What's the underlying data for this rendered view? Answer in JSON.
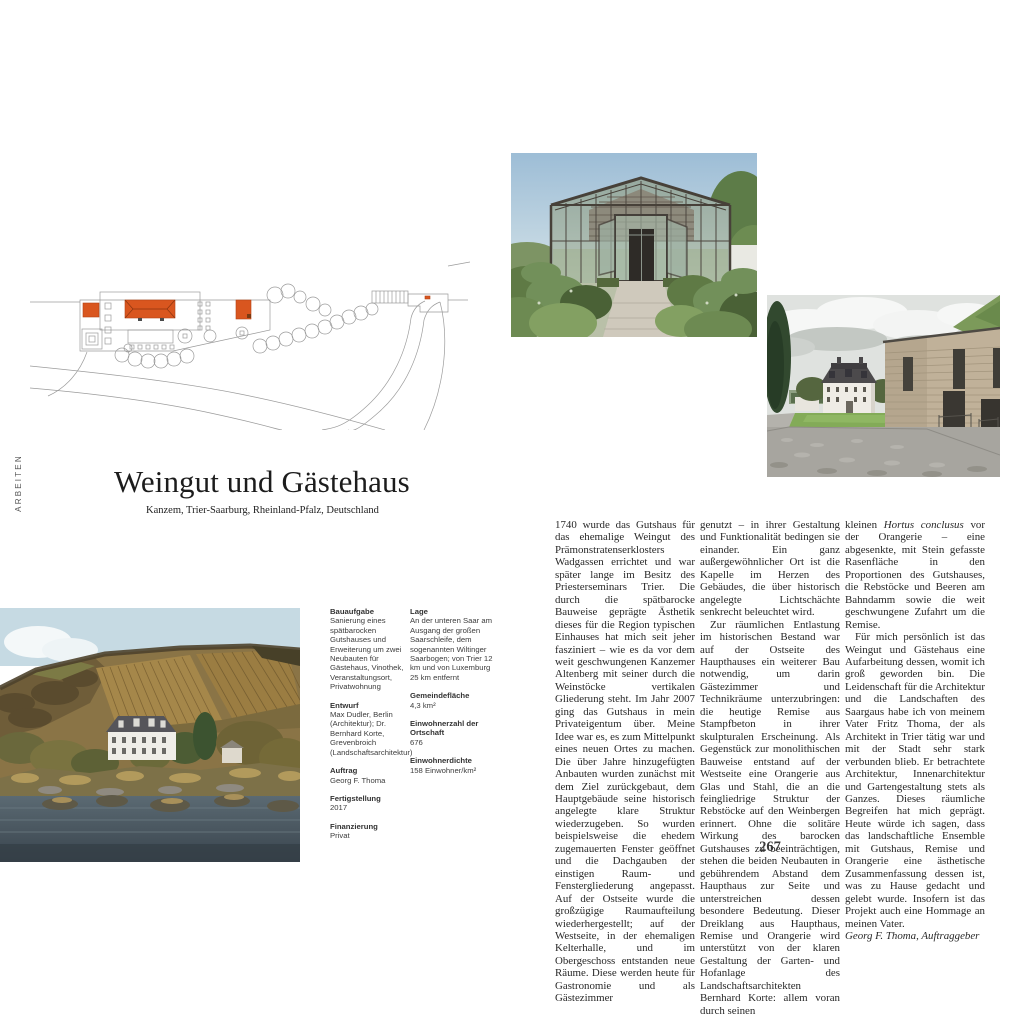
{
  "accent_color": "#d9561f",
  "page": {
    "spine_label": "ARBEITEN",
    "number": "267"
  },
  "header": {
    "title": "Weingut und Gästehaus",
    "subtitle": "Kanzem, Trier-Saarburg, Rheinland-Pfalz, Deutschland"
  },
  "info": {
    "col_a": [
      {
        "label": "Bauaufgabe",
        "value": "Sanierung eines spätbarocken Gutshauses und Erweiterung um zwei Neubauten für Gästehaus, Vinothek, Veranstaltungsort, Privatwohnung"
      },
      {
        "label": "Entwurf",
        "value": "Max Dudler, Berlin (Architektur); Dr. Bernhard Korte, Grevenbroich (Landschaftsarchitektur)"
      },
      {
        "label": "Auftrag",
        "value": "Georg F. Thoma"
      },
      {
        "label": "Fertigstellung",
        "value": "2017"
      },
      {
        "label": "Finanzierung",
        "value": "Privat"
      }
    ],
    "col_b": [
      {
        "label": "Lage",
        "value": "An der unteren Saar am Ausgang der großen Saarschleife, dem sogenannten Wiltinger Saarbogen; von Trier 12 km und von Luxemburg 25 km entfernt"
      },
      {
        "label": "Gemeindefläche",
        "value": "4,3 km²"
      },
      {
        "label": "Einwohnerzahl der Ortschaft",
        "value": "676"
      },
      {
        "label": "Einwohnerdichte",
        "value": "158 Einwohner/km²"
      }
    ]
  },
  "essay": {
    "col1_p1": "1740 wurde das Gutshaus für das ehemalige Weingut des Prämonstratenserklosters Wadgassen errichtet und war später lange im Besitz des Priesterseminars Trier. Die durch die spätbarocke Bauweise geprägte Ästhetik dieses für die Region typischen Einhauses hat mich seit jeher fasziniert – wie es da vor dem weit geschwungenen Kanzemer Altenberg mit seiner durch die Weinstöcke vertikalen Gliederung steht. Im Jahr 2007 ging das Gutshaus in mein Privateigentum über. Meine Idee war es, es zum Mittelpunkt eines neuen Ortes zu machen. Die über Jahre hinzugefügten Anbauten wurden zunächst mit dem Ziel zurückgebaut, dem Hauptgebäude seine historisch angelegte klare Struktur wiederzugeben. So wurden beispielsweise die ehedem zugemauerten Fenster geöffnet und die Dachgauben der einstigen Raum- und Fenstergliederung angepasst. Auf der Ostseite wurde die großzügige Raumaufteilung wiederhergestellt; auf der Westseite, in der ehemaligen Kelterhalle, und im Obergeschoss entstanden neue Räume. Diese werden heute für Gastronomie und als Gästezimmer",
    "col2_p1": "genutzt – in ihrer Gestaltung und Funktionalität bedingen sie einander. Ein ganz außergewöhnlicher Ort ist die Kapelle im Herzen des Gebäudes, die über historisch angelegte Lichtschächte senkrecht beleuchtet wird.",
    "col2_p2": "Zur räumlichen Entlastung im historischen Bestand war auf der Ostseite des Haupthauses ein weiterer Bau notwendig, um darin Gästezimmer und Technikräume unterzubringen: die heutige Remise aus Stampfbeton in ihrer skulpturalen Erscheinung. Als Gegenstück zur monolithischen Bauweise entstand auf der Westseite eine Orangerie aus Glas und Stahl, die an die feingliedrige Struktur der Rebstöcke auf den Weinbergen erinnert. Ohne die solitäre Wirkung des barocken Gutshauses zu beeinträchtigen, stehen die beiden Neubauten in gebührendem Abstand dem Haupthaus zur Seite und unterstreichen dessen besondere Bedeutung. Dieser Dreiklang aus Haupthaus, Remise und Orangerie wird unterstützt von der klaren Gestaltung der Garten- und Hofanlage des Landschaftsarchitekten Bernhard Korte: allem voran durch seinen",
    "col3_p1_pre": "kleinen ",
    "col3_p1_italic": "Hortus conclusus",
    "col3_p1_post": " vor der Orangerie – eine abgesenkte, mit Stein gefasste Rasenfläche in den Proportionen des Gutshauses, die Rebstöcke und Beeren am Bahndamm sowie die weit geschwungene Zufahrt um die Remise.",
    "col3_p2": "Für mich persönlich ist das Weingut und Gästehaus eine Aufarbeitung dessen, womit ich groß geworden bin. Die Leidenschaft für die Architektur und die Landschaften des Saargaus habe ich von meinem Vater Fritz Thoma, der als Architekt in Trier tätig war und mit der Stadt sehr stark verbunden blieb. Er betrachtete Architektur, Innenarchitektur und Gartengestaltung stets als Ganzes. Dieses räumliche Begreifen hat mich geprägt. Heute würde ich sagen, dass das landschaftliche Ensemble mit Gutshaus, Remise und Orangerie eine ästhetische Zusammenfassung dessen ist, was zu Hause gedacht und gelebt wurde. Insofern ist das Projekt auch eine Hommage an meinen Vater.",
    "signature": "Georg F. Thoma, Auftraggeber"
  }
}
